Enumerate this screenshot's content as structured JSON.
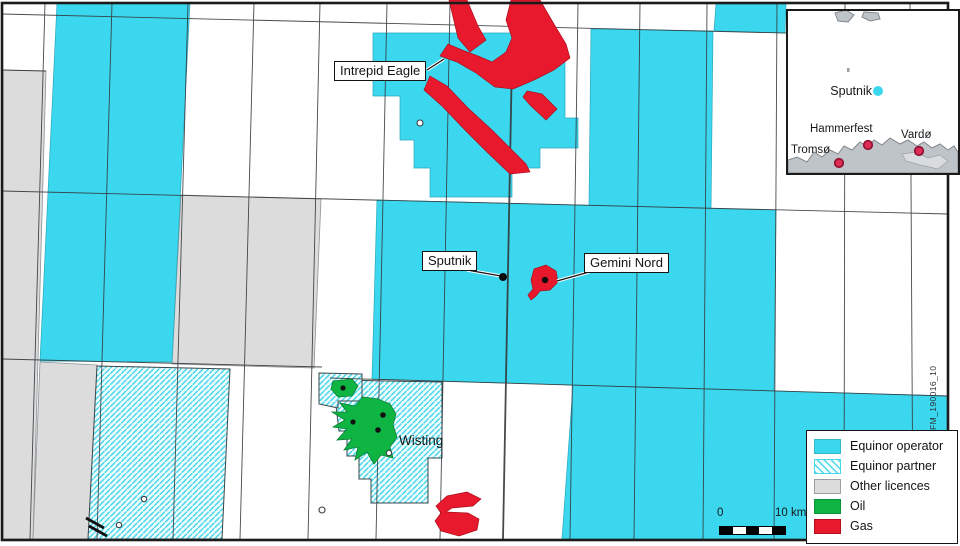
{
  "map_labels": {
    "intrepid_eagle": "Intrepid Eagle",
    "sputnik": "Sputnik",
    "gemini_nord": "Gemini Nord",
    "wisting": "Wisting"
  },
  "inset": {
    "sputnik": "Sputnik",
    "hammerfest": "Hammerfest",
    "vardo": "Vardø",
    "tromso": "Tromsø"
  },
  "legend": {
    "items": [
      {
        "id": "operator",
        "label": "Equinor operator",
        "color": "#3BD7EE",
        "pattern": "solid"
      },
      {
        "id": "partner",
        "label": "Equinor partner",
        "color": "#3BD7EE",
        "pattern": "hatched"
      },
      {
        "id": "other",
        "label": "Other licences",
        "color": "#DCDCDC",
        "pattern": "solid"
      },
      {
        "id": "oil",
        "label": "Oil",
        "color": "#0EB543",
        "pattern": "solid"
      },
      {
        "id": "gas",
        "label": "Gas",
        "color": "#E8192C",
        "pattern": "solid"
      }
    ]
  },
  "scale_bar": {
    "start_label": "0",
    "end_label": "10 km"
  },
  "figure_code": "FM_190016_10",
  "colors": {
    "equinor_operator": "#3BD7EE",
    "equinor_partner_hatch": "#45D5E8",
    "other_licences": "#DCDCDC",
    "oil_green": "#0EB543",
    "gas_red": "#E8192C",
    "inset_land": "#BFC4C9",
    "city_dot": "#DD2C55"
  }
}
